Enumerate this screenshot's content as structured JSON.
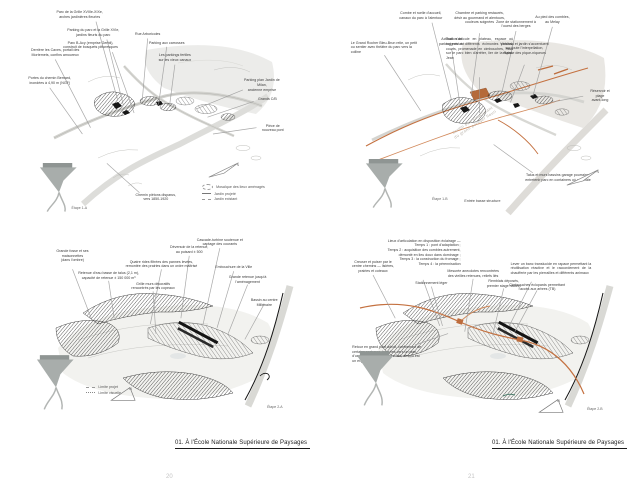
{
  "page": {
    "footer_left": "01. À l'École Nationale Supérieure de Paysages",
    "footer_right": "01. À l'École Nationale Supérieure de Paysages",
    "page_number_left": "20",
    "page_number_right": "21"
  },
  "colors": {
    "accent_orange": "#c47140",
    "accent_orange_light": "#d28a5c",
    "ink": "#262626",
    "leader_gray": "#9a9a9a",
    "wash_gray": "#ececе9"
  },
  "panels": [
    {
      "id": "tl",
      "stage_label": "Étape 1-A",
      "legend": [
        {
          "swatch": "blob",
          "label": "Mosaïque des lieux aménagés"
        },
        {
          "swatch": "solid",
          "label": "Jardin projeté"
        },
        {
          "swatch": "dashed",
          "label": "Jardin existant"
        }
      ],
      "annotations": [
        {
          "t": "Parc de la Grille XVIIIe-XIXe,\narches jardinières fleuries",
          "x": 19,
          "y": 1,
          "l": [
            25,
            6.5,
            33,
            44
          ]
        },
        {
          "t": "Parking du parc et la Grille XVIe,\njardins fleuris du parc",
          "x": 24,
          "y": 9.5,
          "l": [
            29,
            15,
            35,
            46
          ]
        },
        {
          "t": "Parc B-Acy (emprise Gerbil),\nconstruit de bosquets pittoresques",
          "x": 23,
          "y": 15.5,
          "l": [
            31,
            21,
            39,
            50
          ]
        },
        {
          "t": "Rue Arboricoles",
          "x": 44,
          "y": 11.5,
          "l": [
            44,
            14.5,
            42,
            44
          ]
        },
        {
          "t": "Parking aux carrosses",
          "x": 51,
          "y": 15.5,
          "l": [
            51,
            18.5,
            48,
            46
          ]
        },
        {
          "t": "Les parkings fertiles\nsur les vieux canaux",
          "x": 54,
          "y": 21.5,
          "l": [
            54,
            27,
            52,
            47
          ]
        },
        {
          "t": "Derrière les Caves, portail des\nMortemets, confins amoureux",
          "x": 10,
          "y": 19,
          "l": [
            10,
            24.5,
            23,
            57
          ]
        },
        {
          "t": "Portes du chemin Bernard,\ninondées à 4,90 m (NGF)",
          "x": 8,
          "y": 32.5,
          "l": [
            8,
            38,
            20,
            60
          ]
        },
        {
          "t": "Parking plan Jardin de Milan,\nancienne emprise",
          "x": 86,
          "y": 33.5,
          "l": [
            79,
            39,
            62,
            48
          ]
        },
        {
          "t": "Grands C/B",
          "x": 88,
          "y": 42.5,
          "l": [
            83,
            44.5,
            66,
            52
          ]
        },
        {
          "t": "Pièce de nouveau pont",
          "x": 90,
          "y": 55,
          "l": [
            84,
            57,
            68,
            60
          ]
        },
        {
          "t": "Chemin piétons disparus,\nvers 1850-1920",
          "x": 47,
          "y": 88,
          "l": [
            41,
            88,
            29,
            74
          ]
        }
      ]
    },
    {
      "id": "tr",
      "stage_label": "Étape 1-B",
      "caption": "Entrée basse structure",
      "watermark": "Jardin bas structurant\ndu grand potager fleuri",
      "annotations": [
        {
          "t": "Combe et ruelle d'accueil,\ncanaux du parc à l'alentour",
          "x": 26,
          "y": 1.5,
          "l": [
            30,
            7,
            37,
            44
          ]
        },
        {
          "t": "Chambre et parking restaurés,\ndésir au gourmand et alentours,\ncouleurs soignées",
          "x": 47,
          "y": 1.5,
          "l": [
            47,
            12,
            44,
            42
          ]
        },
        {
          "t": "Zone de stationnement à\nl'ouest des berges",
          "x": 60,
          "y": 5.5,
          "l": [
            60,
            11,
            55,
            40
          ]
        },
        {
          "t": "Au pied des combles,\nau Melay",
          "x": 73,
          "y": 3.5,
          "l": [
            73,
            9,
            66,
            42
          ]
        },
        {
          "t": "Activation du\nparking existant",
          "x": 37,
          "y": 14,
          "l": [
            37,
            19.5,
            40,
            46
          ]
        },
        {
          "t": "Tout s'articule en plateau, espace où soigner à différents écimonies publics, courts, promenade en cimbouches, mais sur le parc bien d'arrêter, lier de la Saint-Jean",
          "x": 47,
          "y": 14,
          "w": 24,
          "a": "justify",
          "l": [
            47,
            33,
            47,
            50
          ]
        },
        {
          "t": "Véranda et jardin s'accentuent\nsur toute l'interpellation,\nespace des pique-niqueurs",
          "x": 63,
          "y": 16,
          "l": [
            63,
            27,
            58,
            45
          ]
        },
        {
          "t": "Le Grand Rocher Bleu-Brun relie, un petit ou sentier avec théâtre du parc vers la colline",
          "x": 13,
          "y": 15.5,
          "w": 24,
          "a": "left",
          "l": [
            13,
            22.5,
            26,
            49
          ]
        },
        {
          "t": "Réservoir et plage\navant-long",
          "x": 90,
          "y": 38.5,
          "l": [
            84,
            42,
            72,
            45
          ]
        },
        {
          "t": "Talus et murs bassins garage pourraient\nentretenir parc en containers où une haie",
          "x": 75,
          "y": 78.5,
          "l": [
            66,
            78.5,
            52,
            65
          ]
        }
      ]
    },
    {
      "id": "bl",
      "stage_label": "Étape 2-A",
      "legend": [
        {
          "swatch": "dashed",
          "label": "Limite projet"
        },
        {
          "swatch": "dashed2",
          "label": "Limite visuelle"
        }
      ],
      "annotations": [
        {
          "t": "Grande fosse et ses\nmaisonnettes\n(dans l'ombre)",
          "x": 16,
          "y": 11,
          "l": [
            16,
            21.5,
            23,
            48
          ]
        },
        {
          "t": "Retenue d'eau basse de talus (2,1 m),\ncapacité de retenue ± 150 000 m³",
          "x": 29,
          "y": 22.5,
          "l": [
            29,
            27.5,
            31,
            47
          ]
        },
        {
          "t": "Quatre rides filtrées des pannes levées,\nremontée des prairies dans un ordre maîtrisé",
          "x": 48,
          "y": 16.5,
          "l": [
            48,
            21.5,
            44,
            50
          ]
        },
        {
          "t": "Grille murs décoratifs\nrencontrés par les copeaux",
          "x": 45,
          "y": 28,
          "l": [
            45,
            33,
            46,
            55
          ]
        },
        {
          "t": "Déversoir de la retenue,\nau puisard ± 500",
          "x": 58,
          "y": 9,
          "l": [
            58,
            14.5,
            55,
            47
          ]
        },
        {
          "t": "Cascade-turbine soutenue et\ncaptage des courants",
          "x": 69,
          "y": 5,
          "l": [
            69,
            10.5,
            63,
            50
          ]
        },
        {
          "t": "Embouchure de la Ville",
          "x": 74,
          "y": 19.5,
          "l": [
            74,
            22.5,
            68,
            52
          ]
        },
        {
          "t": "Grande retenue jusqu'à\nl'aménagement",
          "x": 79,
          "y": 24.5,
          "l": [
            79,
            29.5,
            72,
            55
          ]
        },
        {
          "t": "Bassin au centre Millénaire",
          "x": 85,
          "y": 36.5,
          "l": [
            85,
            39.5,
            78,
            58
          ]
        }
      ]
    },
    {
      "id": "br",
      "stage_label": "Étape 2-B",
      "annotations": [
        {
          "t": "Lieux d'articulation en disposition éclairage —\nTemps 1 : pont d'adaptation ;\nTemps 2 : acquisition des combles autrement,\ndémonté en lieu doux dans dominage ;\nTemps 3 : la construction du fromage ;\nTemps 4 : la pérennisation",
          "x": 27,
          "y": 5.5,
          "w": 27,
          "a": "right",
          "l": [
            27,
            27,
            33,
            51
          ]
        },
        {
          "t": "Creuser et puiser par le\ncentre chemins — lisières,\nprairies et coteaux",
          "x": 9,
          "y": 16.5,
          "l": [
            9,
            24.5,
            17,
            47
          ]
        },
        {
          "t": "Stationnement léger",
          "x": 30,
          "y": 27.5,
          "l": [
            30,
            30.5,
            34,
            51
          ]
        },
        {
          "t": "Mesurée anecdotes rencontrées\ndes vieilles retenues, reliefs liés",
          "x": 45,
          "y": 21.5,
          "l": [
            45,
            26.5,
            42,
            54
          ]
        },
        {
          "t": "Remblais déposés,\npremier stage naturel",
          "x": 56,
          "y": 26.5,
          "l": [
            56,
            31.5,
            52,
            56
          ]
        },
        {
          "t": "Lever un banc translucide en rapace permettant la réutilisation réactive et le raccordement de la chaufferie par les pierrailles et différents animaux",
          "x": 73,
          "y": 17.5,
          "w": 29,
          "a": "justify",
          "l": [
            66,
            28,
            58,
            51
          ]
        },
        {
          "t": "Cimbrouches éclopards permettant\nl'accès aux arbres (TB)",
          "x": 68,
          "y": 28.5,
          "l": [
            68,
            32.5,
            60,
            54
          ]
        },
        {
          "t": "Retour en grand pont adroit, conformant de certains parterres, hanches vers un plan d'une grille ; pour en écrire l'art, absolu est un enjeu",
          "x": 14,
          "y": 61,
          "w": 25,
          "a": "left",
          "l": [
            24,
            61,
            36,
            55
          ]
        }
      ]
    }
  ]
}
